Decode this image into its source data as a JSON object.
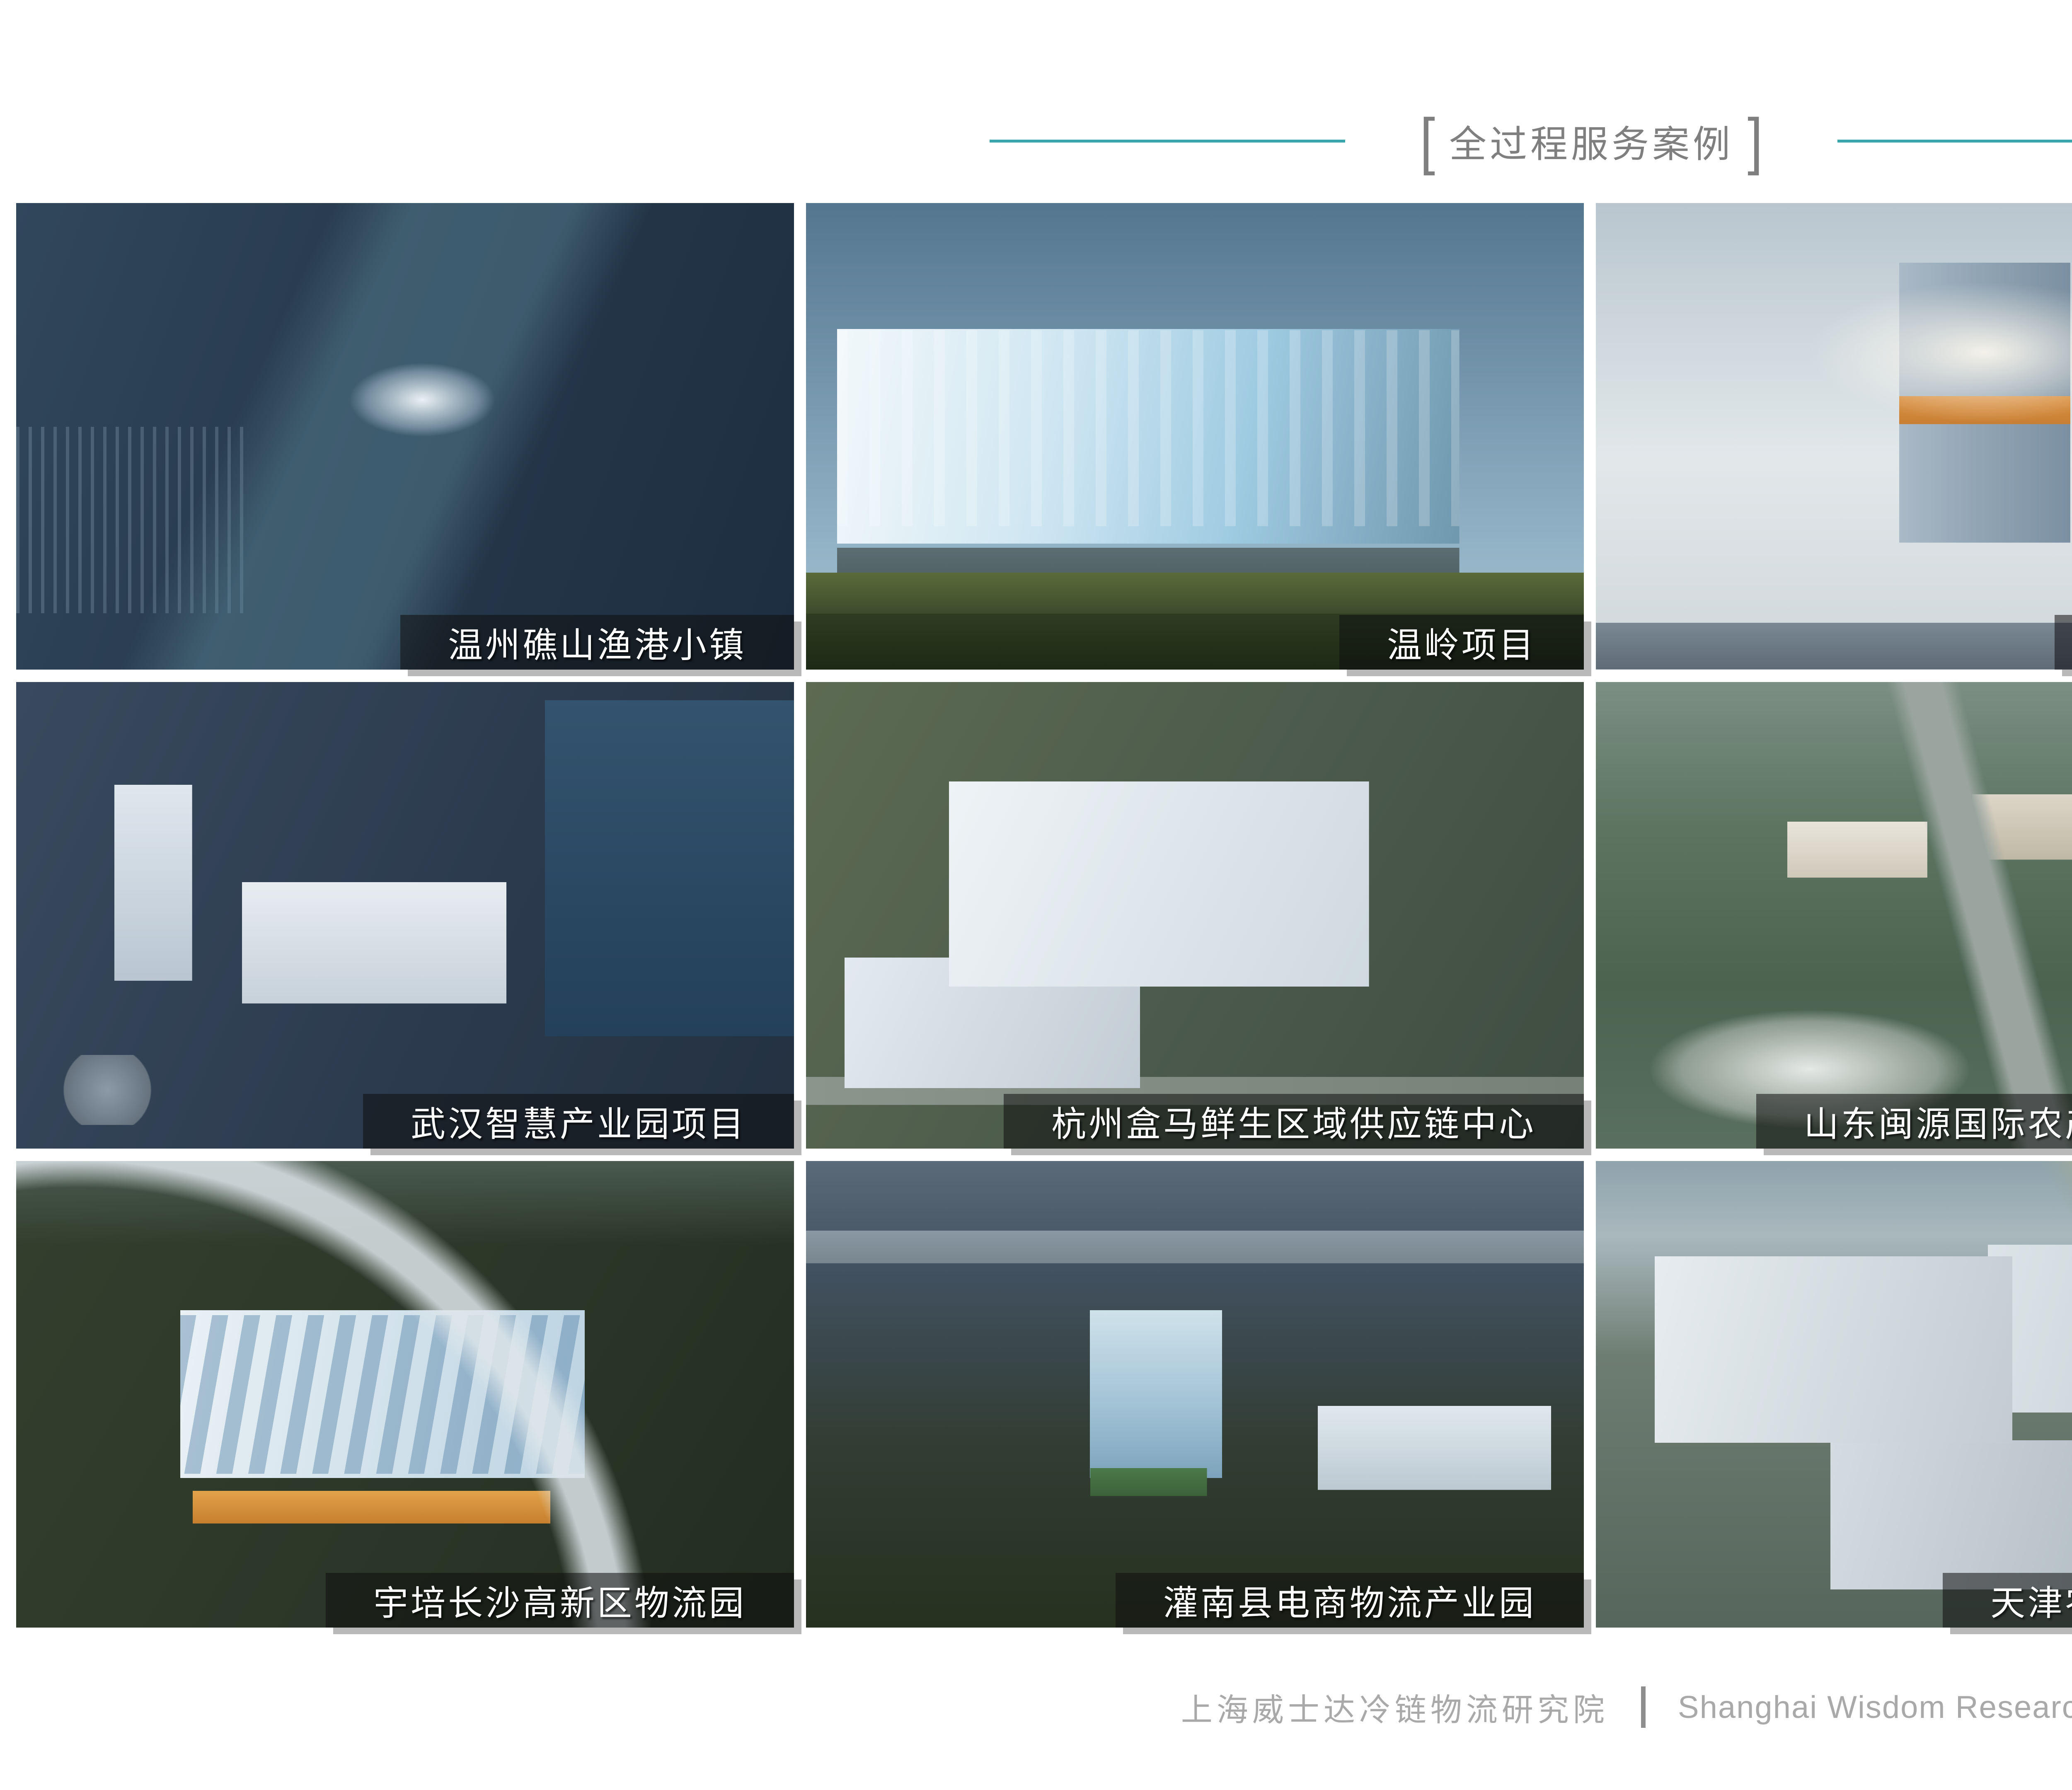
{
  "slide": {
    "title": {
      "bracket_left": "[",
      "text": "全过程服务案例",
      "bracket_right": "]",
      "text_color": "#7F7F7F",
      "accent_line_color": "#3AA6AC"
    },
    "caption_style": {
      "bar_color": "rgba(15,15,15,0.55)",
      "text_color": "#FFFFFF",
      "shadow_color": "#808080"
    },
    "projects": [
      {
        "label": "温州礁山渔港小镇"
      },
      {
        "label": "温岭项目"
      },
      {
        "label": "上海金山项目"
      },
      {
        "label": "舟山渔港项目"
      },
      {
        "label": "武汉智慧产业园项目"
      },
      {
        "label": "杭州盒马鲜生区域供应链中心"
      },
      {
        "label": "山东闽源国际农产品物流产业园"
      },
      {
        "label": "湖州农副产品物流集散中心"
      },
      {
        "label": "宇培长沙高新区物流园"
      },
      {
        "label": "灌南县电商物流产业园"
      },
      {
        "label": "天津农产品加工项目"
      },
      {
        "label": "长春市北湖冷链物流产业园"
      }
    ],
    "footer": {
      "cn": "上海威士达冷链物流研究院",
      "divider": "|",
      "en": "Shanghai Wisdom Research",
      "text_color": "#A9A9A9"
    }
  }
}
